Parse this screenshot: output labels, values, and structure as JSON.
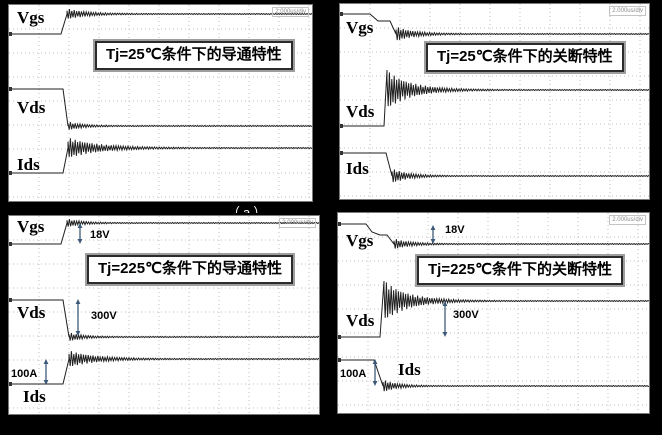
{
  "page": {
    "background": "#000000"
  },
  "colors": {
    "trace": "#1f1f1f",
    "grid": "#c0c0c0",
    "arrow": "#3d5a78",
    "panel_bg": "#ffffff"
  },
  "cropped_label_fragment": "（a）",
  "chart_data": [
    {
      "type": "line",
      "title": "Tj=25℃条件下的导通特性",
      "xlabel": "time",
      "timebase": "2.000us/div",
      "grid": "dotted",
      "series": [
        {
          "name": "Vgs",
          "behavior": "low level, fast step-up with overshoot ringing, settles high"
        },
        {
          "name": "Vds",
          "behavior": "high level, fast step-down with undershoot ringing, settles low"
        },
        {
          "name": "Ids",
          "behavior": "low level, fast step-up with heavy decaying ringing, settles high"
        }
      ]
    },
    {
      "type": "line",
      "title": "Tj=25℃条件下的关断特性",
      "xlabel": "time",
      "timebase": "2.000us/div",
      "grid": "dotted",
      "series": [
        {
          "name": "Vgs",
          "behavior": "high level, two-step fall (Miller plateau) with decaying ringing, settles low"
        },
        {
          "name": "Vds",
          "behavior": "low level, fast step-up with large overshoot spike and decaying ringing, settles high"
        },
        {
          "name": "Ids",
          "behavior": "high level, fast step-down with decaying ringing, settles low"
        }
      ]
    },
    {
      "type": "line",
      "title": "Tj=225℃条件下的导通特性",
      "xlabel": "time",
      "timebase": "2.000us/div",
      "grid": "dotted",
      "annotated_values": {
        "Vgs": "18V",
        "Vds": "300V",
        "Ids": "100A"
      },
      "series": [
        {
          "name": "Vgs",
          "behavior": "low level, fast step-up (swing 18V) with small ringing",
          "amplitude": "18V"
        },
        {
          "name": "Vds",
          "behavior": "high level, fast step-down (swing 300V) with ringing",
          "amplitude": "300V"
        },
        {
          "name": "Ids",
          "behavior": "low level, fast step-up (swing 100A) with decaying ringing",
          "amplitude": "100A"
        }
      ]
    },
    {
      "type": "line",
      "title": "Tj=225℃条件下的关断特性",
      "xlabel": "time",
      "timebase": "2.000us/div",
      "grid": "dotted",
      "annotated_values": {
        "Vgs": "18V",
        "Vds": "300V",
        "Ids": "100A"
      },
      "series": [
        {
          "name": "Vgs",
          "behavior": "high level, two-step fall (swing 18V) with decaying ringing",
          "amplitude": "18V"
        },
        {
          "name": "Vds",
          "behavior": "low level, step-up with large overshoot spike (swing 300V), settles high",
          "amplitude": "300V"
        },
        {
          "name": "Ids",
          "behavior": "high level, fast step-down (swing 100A) with ringing",
          "amplitude": "100A"
        }
      ]
    }
  ],
  "panels": [
    {
      "id": "tl",
      "caption": "Tj=25℃条件下的导通特性",
      "corner_text": "2.000us/div",
      "size": {
        "w": 303,
        "h": 196
      },
      "grid": {
        "dx": 30,
        "dy": 24
      },
      "labels": [
        {
          "text": "Vgs",
          "x": 8,
          "y": 18
        },
        {
          "text": "Vds",
          "x": 8,
          "y": 108
        },
        {
          "text": "Ids",
          "x": 8,
          "y": 165
        }
      ],
      "annotations": [],
      "traces": [
        {
          "name": "Vgs",
          "segments": [
            {
              "t": "m",
              "x": 0,
              "y": 29
            },
            {
              "t": "h",
              "x": 52
            },
            {
              "t": "l",
              "x": 58,
              "y": 9
            },
            {
              "t": "ring",
              "x2": 303,
              "y": 9,
              "amp": 5,
              "tau": 20
            }
          ]
        },
        {
          "name": "Vds",
          "segments": [
            {
              "t": "m",
              "x": 0,
              "y": 84
            },
            {
              "t": "h",
              "x": 54
            },
            {
              "t": "l",
              "x": 59,
              "y": 121
            },
            {
              "t": "ring",
              "x2": 303,
              "y": 121,
              "amp": 4,
              "tau": 14
            }
          ]
        },
        {
          "name": "Ids",
          "segments": [
            {
              "t": "m",
              "x": 0,
              "y": 168
            },
            {
              "t": "h",
              "x": 54
            },
            {
              "t": "l",
              "x": 59,
              "y": 143
            },
            {
              "t": "ring",
              "x2": 303,
              "y": 143,
              "amp": 10,
              "tau": 30
            }
          ]
        }
      ]
    },
    {
      "id": "tr",
      "caption": "Tj=25℃条件下的关断特性",
      "corner_text": "2.000us/div",
      "size": {
        "w": 309,
        "h": 195
      },
      "grid": {
        "dx": 30,
        "dy": 24
      },
      "labels": [
        {
          "text": "Vgs",
          "x": 6,
          "y": 29
        },
        {
          "text": "Vds",
          "x": 6,
          "y": 113
        },
        {
          "text": "Ids",
          "x": 6,
          "y": 170
        }
      ],
      "annotations": [],
      "traces": [
        {
          "name": "Vgs",
          "segments": [
            {
              "t": "m",
              "x": 0,
              "y": 10
            },
            {
              "t": "h",
              "x": 30
            },
            {
              "t": "l",
              "x": 38,
              "y": 17
            },
            {
              "t": "h",
              "x": 50
            },
            {
              "t": "l",
              "x": 56,
              "y": 30
            },
            {
              "t": "ring",
              "x2": 309,
              "y": 30,
              "amp": 7,
              "tau": 18
            }
          ]
        },
        {
          "name": "Vds",
          "segments": [
            {
              "t": "m",
              "x": 0,
              "y": 122
            },
            {
              "t": "h",
              "x": 44
            },
            {
              "t": "l",
              "x": 47,
              "y": 66
            },
            {
              "t": "ring",
              "x2": 309,
              "y": 86,
              "amp": 19,
              "tau": 24
            }
          ]
        },
        {
          "name": "Ids",
          "segments": [
            {
              "t": "m",
              "x": 0,
              "y": 149
            },
            {
              "t": "h",
              "x": 46
            },
            {
              "t": "l",
              "x": 52,
              "y": 172
            },
            {
              "t": "ring",
              "x2": 309,
              "y": 172,
              "amp": 7,
              "tau": 16
            }
          ]
        }
      ]
    },
    {
      "id": "bl",
      "caption": "Tj=225℃条件下的导通特性",
      "corner_text": "2.000us/div",
      "size": {
        "w": 310,
        "h": 198
      },
      "grid": {
        "dx": 30,
        "dy": 24
      },
      "labels": [
        {
          "text": "Vgs",
          "x": 8,
          "y": 16
        },
        {
          "text": "Vds",
          "x": 8,
          "y": 102
        },
        {
          "text": "Ids",
          "x": 14,
          "y": 186
        }
      ],
      "annotations": [
        {
          "text": "18V",
          "ax": 71,
          "y1": 7,
          "y2": 28,
          "tx": 81,
          "ty": 22
        },
        {
          "text": "300V",
          "ax": 69,
          "y1": 83,
          "y2": 120,
          "tx": 82,
          "ty": 103
        },
        {
          "text": "100A",
          "ax": 37,
          "y1": 143,
          "y2": 169,
          "tx": 2,
          "ty": 161
        }
      ],
      "traces": [
        {
          "name": "Vgs",
          "segments": [
            {
              "t": "m",
              "x": 0,
              "y": 28
            },
            {
              "t": "h",
              "x": 52
            },
            {
              "t": "l",
              "x": 58,
              "y": 7
            },
            {
              "t": "ring",
              "x2": 310,
              "y": 7,
              "amp": 4,
              "tau": 14
            }
          ]
        },
        {
          "name": "Vds",
          "segments": [
            {
              "t": "m",
              "x": 0,
              "y": 84
            },
            {
              "t": "h",
              "x": 54
            },
            {
              "t": "l",
              "x": 60,
              "y": 121
            },
            {
              "t": "ring",
              "x2": 310,
              "y": 121,
              "amp": 4,
              "tau": 14
            }
          ]
        },
        {
          "name": "Ids",
          "segments": [
            {
              "t": "m",
              "x": 0,
              "y": 168
            },
            {
              "t": "h",
              "x": 54
            },
            {
              "t": "l",
              "x": 60,
              "y": 143
            },
            {
              "t": "ring",
              "x2": 310,
              "y": 143,
              "amp": 8,
              "tau": 26
            }
          ]
        }
      ]
    },
    {
      "id": "br",
      "caption": "Tj=225℃条件下的关断特性",
      "corner_text": "2.000us/div",
      "size": {
        "w": 311,
        "h": 200
      },
      "grid": {
        "dx": 30,
        "dy": 24
      },
      "labels": [
        {
          "text": "Vgs",
          "x": 8,
          "y": 33
        },
        {
          "text": "Vds",
          "x": 8,
          "y": 113
        },
        {
          "text": "Ids",
          "x": 60,
          "y": 162
        }
      ],
      "annotations": [
        {
          "text": "18V",
          "ax": 95,
          "y1": 12,
          "y2": 31,
          "tx": 107,
          "ty": 20
        },
        {
          "text": "300V",
          "ax": 107,
          "y1": 88,
          "y2": 124,
          "tx": 115,
          "ty": 105
        },
        {
          "text": "100A",
          "ax": 37,
          "y1": 146,
          "y2": 173,
          "tx": 2,
          "ty": 164
        }
      ],
      "traces": [
        {
          "name": "Vgs",
          "segments": [
            {
              "t": "m",
              "x": 0,
              "y": 11
            },
            {
              "t": "h",
              "x": 28
            },
            {
              "t": "l",
              "x": 34,
              "y": 19
            },
            {
              "t": "l",
              "x": 42,
              "y": 22
            },
            {
              "t": "h",
              "x": 49
            },
            {
              "t": "l",
              "x": 56,
              "y": 31
            },
            {
              "t": "ring",
              "x2": 311,
              "y": 31,
              "amp": 5,
              "tau": 16
            }
          ]
        },
        {
          "name": "Vds",
          "segments": [
            {
              "t": "m",
              "x": 0,
              "y": 124
            },
            {
              "t": "h",
              "x": 42
            },
            {
              "t": "l",
              "x": 46,
              "y": 68
            },
            {
              "t": "ring",
              "x2": 311,
              "y": 88,
              "amp": 20,
              "tau": 24
            }
          ]
        },
        {
          "name": "Ids",
          "segments": [
            {
              "t": "m",
              "x": 0,
              "y": 147
            },
            {
              "t": "h",
              "x": 36
            },
            {
              "t": "l",
              "x": 45,
              "y": 173
            },
            {
              "t": "ring",
              "x2": 311,
              "y": 173,
              "amp": 6,
              "tau": 14
            }
          ]
        }
      ]
    }
  ]
}
